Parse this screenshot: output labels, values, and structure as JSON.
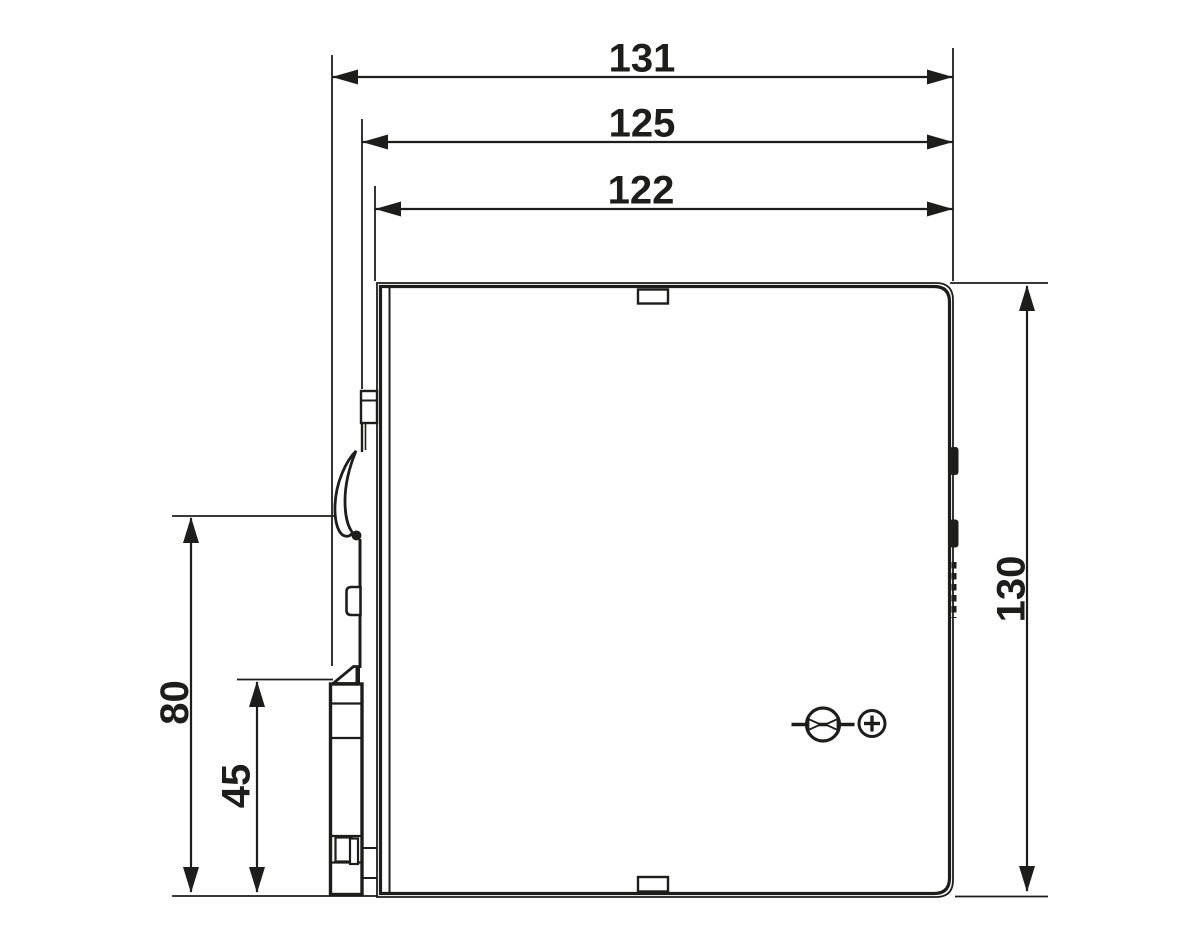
{
  "colors": {
    "line": "#1d1d1b",
    "background": "#ffffff"
  },
  "drawing": {
    "dimensions": {
      "width_overall": "131",
      "width_housing": "125",
      "width_front_face": "122",
      "height_overall": "130",
      "height_upper_left": "80",
      "height_lower_left": "45"
    },
    "icons": {
      "voltage_adjust": "potentiometer-adjust-icon",
      "polarity_plus": "plus-polarity-icon"
    }
  }
}
